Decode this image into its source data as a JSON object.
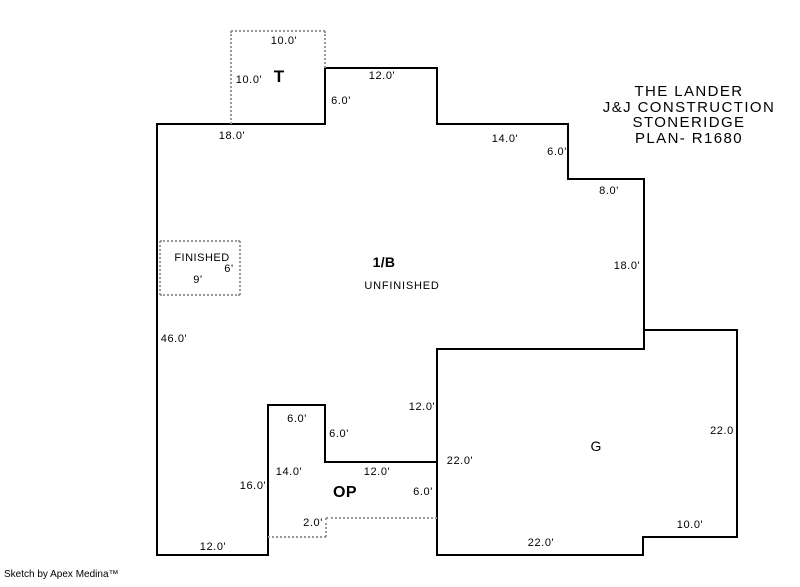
{
  "page": {
    "width": 800,
    "height": 587,
    "background": "#ffffff",
    "wall_color": "#000000",
    "dotted_color": "#999999"
  },
  "title_block": {
    "lines": [
      "THE LANDER",
      "J&J CONSTRUCTION",
      "STONERIDGE",
      "PLAN- R1680"
    ]
  },
  "credit": "Sketch by Apex Medina™",
  "sketch": {
    "solid_walls": [
      {
        "x1": 157,
        "y1": 124,
        "x2": 325,
        "y2": 124
      },
      {
        "x1": 325,
        "y1": 68,
        "x2": 325,
        "y2": 124
      },
      {
        "x1": 325,
        "y1": 68,
        "x2": 437,
        "y2": 68
      },
      {
        "x1": 437,
        "y1": 68,
        "x2": 437,
        "y2": 124
      },
      {
        "x1": 437,
        "y1": 124,
        "x2": 568,
        "y2": 124
      },
      {
        "x1": 568,
        "y1": 124,
        "x2": 568,
        "y2": 179
      },
      {
        "x1": 568,
        "y1": 179,
        "x2": 644,
        "y2": 179
      },
      {
        "x1": 644,
        "y1": 179,
        "x2": 644,
        "y2": 349
      },
      {
        "x1": 437,
        "y1": 349,
        "x2": 644,
        "y2": 349
      },
      {
        "x1": 644,
        "y1": 330,
        "x2": 737,
        "y2": 330
      },
      {
        "x1": 737,
        "y1": 330,
        "x2": 737,
        "y2": 537
      },
      {
        "x1": 643,
        "y1": 537,
        "x2": 737,
        "y2": 537
      },
      {
        "x1": 643,
        "y1": 537,
        "x2": 643,
        "y2": 555
      },
      {
        "x1": 437,
        "y1": 555,
        "x2": 643,
        "y2": 555
      },
      {
        "x1": 437,
        "y1": 349,
        "x2": 437,
        "y2": 555
      },
      {
        "x1": 325,
        "y1": 462,
        "x2": 437,
        "y2": 462
      },
      {
        "x1": 325,
        "y1": 405,
        "x2": 325,
        "y2": 462
      },
      {
        "x1": 268,
        "y1": 405,
        "x2": 325,
        "y2": 405
      },
      {
        "x1": 268,
        "y1": 405,
        "x2": 268,
        "y2": 555
      },
      {
        "x1": 157,
        "y1": 555,
        "x2": 268,
        "y2": 555
      },
      {
        "x1": 157,
        "y1": 124,
        "x2": 157,
        "y2": 555
      }
    ],
    "dotted_walls": [
      {
        "x1": 231,
        "y1": 31,
        "x2": 325,
        "y2": 31
      },
      {
        "x1": 231,
        "y1": 31,
        "x2": 231,
        "y2": 124
      },
      {
        "x1": 325,
        "y1": 31,
        "x2": 325,
        "y2": 68
      },
      {
        "x1": 160,
        "y1": 241,
        "x2": 240,
        "y2": 241
      },
      {
        "x1": 240,
        "y1": 241,
        "x2": 240,
        "y2": 295
      },
      {
        "x1": 160,
        "y1": 295,
        "x2": 240,
        "y2": 295
      },
      {
        "x1": 160,
        "y1": 241,
        "x2": 160,
        "y2": 295
      },
      {
        "x1": 326,
        "y1": 518,
        "x2": 437,
        "y2": 518
      },
      {
        "x1": 326,
        "y1": 518,
        "x2": 326,
        "y2": 537
      },
      {
        "x1": 268,
        "y1": 537,
        "x2": 326,
        "y2": 537
      }
    ],
    "dimension_labels": [
      {
        "text": "10.0'",
        "x": 284,
        "y": 41
      },
      {
        "text": "10.0'",
        "x": 249,
        "y": 80
      },
      {
        "text": "12.0'",
        "x": 382,
        "y": 76
      },
      {
        "text": "6.0'",
        "x": 341,
        "y": 101
      },
      {
        "text": "18.0'",
        "x": 232,
        "y": 136
      },
      {
        "text": "14.0'",
        "x": 505,
        "y": 139
      },
      {
        "text": "6.0'",
        "x": 557,
        "y": 152
      },
      {
        "text": "8.0'",
        "x": 609,
        "y": 191
      },
      {
        "text": "18.0'",
        "x": 627,
        "y": 266
      },
      {
        "text": "46.0'",
        "x": 174,
        "y": 339
      },
      {
        "text": "6'",
        "x": 229,
        "y": 269
      },
      {
        "text": "9'",
        "x": 198,
        "y": 280
      },
      {
        "text": "12.0'",
        "x": 422,
        "y": 407
      },
      {
        "text": "6.0'",
        "x": 297,
        "y": 419
      },
      {
        "text": "6.0'",
        "x": 339,
        "y": 434
      },
      {
        "text": "14.0'",
        "x": 289,
        "y": 472
      },
      {
        "text": "16.0'",
        "x": 253,
        "y": 486
      },
      {
        "text": "12.0'",
        "x": 377,
        "y": 472
      },
      {
        "text": "6.0'",
        "x": 423,
        "y": 492
      },
      {
        "text": "2.0'",
        "x": 313,
        "y": 523
      },
      {
        "text": "12.0'",
        "x": 213,
        "y": 547
      },
      {
        "text": "22.0'",
        "x": 460,
        "y": 461
      },
      {
        "text": "22.0",
        "x": 722,
        "y": 431
      },
      {
        "text": "10.0'",
        "x": 690,
        "y": 525
      },
      {
        "text": "22.0'",
        "x": 541,
        "y": 543
      }
    ],
    "area_labels": [
      {
        "name": "area-label-t",
        "text": "T",
        "x": 279,
        "y": 77,
        "size": 17,
        "bold": true,
        "ls": 0
      },
      {
        "name": "area-label-finished",
        "text": "FINISHED",
        "x": 202,
        "y": 258,
        "size": 11,
        "bold": false,
        "ls": 0.5
      },
      {
        "name": "area-label-1b",
        "text": "1/B",
        "x": 384,
        "y": 262,
        "size": 14,
        "bold": true,
        "ls": 0.3
      },
      {
        "name": "area-label-unfinished",
        "text": "UNFINISHED",
        "x": 402,
        "y": 286,
        "size": 11,
        "bold": false,
        "ls": 0.8
      },
      {
        "name": "area-label-op",
        "text": "OP",
        "x": 345,
        "y": 493,
        "size": 16,
        "bold": true,
        "ls": 0.5
      },
      {
        "name": "area-label-g",
        "text": "G",
        "x": 596,
        "y": 446,
        "size": 14,
        "bold": false,
        "ls": 0
      }
    ]
  }
}
